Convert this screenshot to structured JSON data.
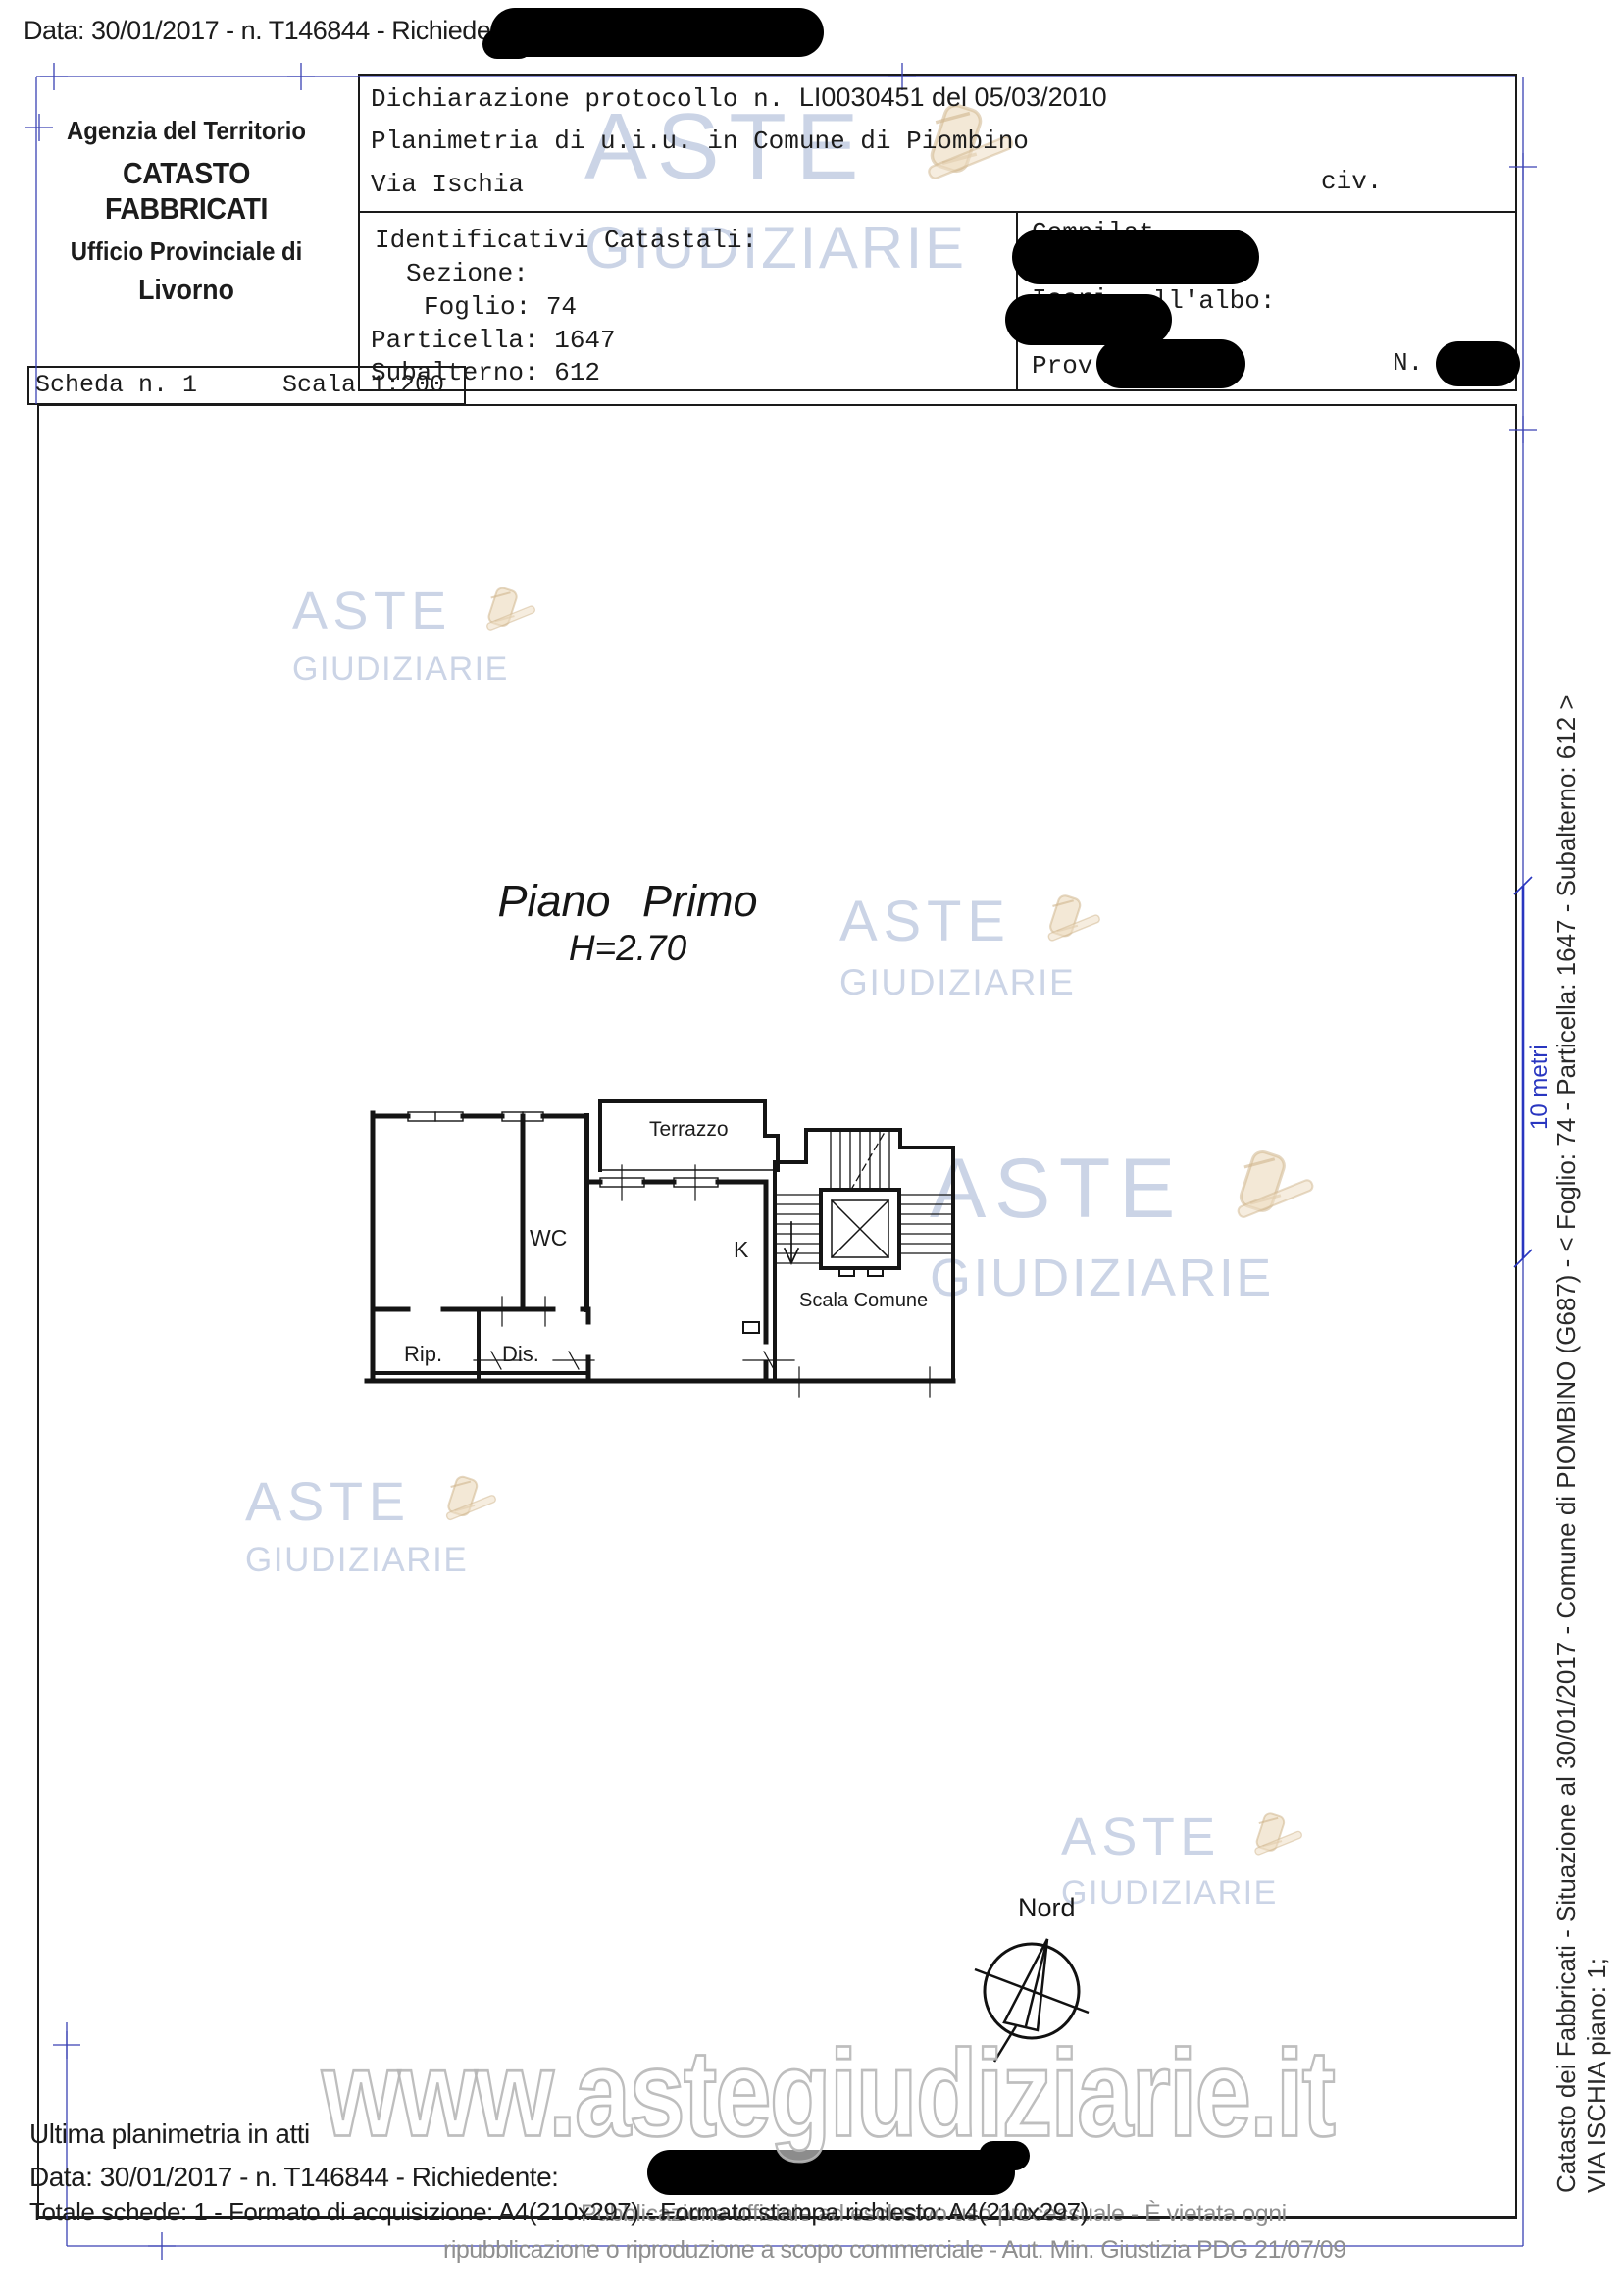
{
  "header": {
    "top_line": "Data: 30/01/2017 - n. T146844 - Richiedent",
    "agency": {
      "line1": "Agenzia del Territorio",
      "line2": "CATASTO FABBRICATI",
      "line3": "Ufficio Provinciale di",
      "line4": "Livorno"
    }
  },
  "declaration": {
    "row1_label": "Dichiarazione protocollo n.",
    "row1_value": "LI0030451 del 05/03/2010",
    "row2": "Planimetria di u.i.u. in Comune di Piombino",
    "row3": "Via Ischia",
    "row3_civ": "civ.",
    "ident_title": "Identificativi Catastali:",
    "sezione": "Sezione:",
    "foglio": "Foglio: 74",
    "particella": "Particella: 1647",
    "subalterno": "Subalterno: 612",
    "compilato_fragment": "Compilat",
    "iscritto_fragment": "Iscri",
    "albo_fragment": "all'albo:",
    "prov_label": "Prov.",
    "n_label": "N."
  },
  "scheda": {
    "scheda": "Scheda n. 1",
    "scala": "Scala 1:200"
  },
  "plan": {
    "title": "Piano Primo",
    "height": "H=2.70",
    "rooms": {
      "terrazzo": "Terrazzo",
      "wc": "WC",
      "k": "K",
      "rip": "Rip.",
      "dis": "Dis.",
      "scala_comune": "Scala Comune"
    },
    "north_label": "Nord",
    "scalebar_label": "10 metri"
  },
  "side_text": {
    "line1": "Catasto dei Fabbricati - Situazione al 30/01/2017 - Comune di PIOMBINO (G687) - < Foglio: 74 - Particella: 1647 - Subalterno: 612 >",
    "line2": "VIA ISCHIA piano: 1;"
  },
  "footer": {
    "ultima": "Ultima planimetria in atti",
    "data_line": "Data: 30/01/2017 - n. T146844 - Richiedente:",
    "totale_line": "Totale schede: 1 - Formato di acquisizione: A4(210x297) - Formato stampa richiesto: A4(210x297)"
  },
  "disclaimer": {
    "line1": "Pubblicazione ufficiale ad esclusivo uso processuale - È vietata ogni",
    "line2": "ripubblicazione o riproduzione a scopo commerciale - Aut. Min. Giustizia PDG 21/07/09"
  },
  "watermark": {
    "line1": "ASTE",
    "line2": "GIUDIZIARIE",
    "url": "www.astegiudiziarie.it"
  },
  "colors": {
    "registration_blue": "#3a42b4",
    "scalebar_blue": "#2936c0",
    "watermark_blue": "#a0b1d2",
    "gavel_tan": "#e8d3ae",
    "gray_text": "#8f8f8f",
    "redaction": "#000000",
    "ink": "#1a1a1a"
  }
}
